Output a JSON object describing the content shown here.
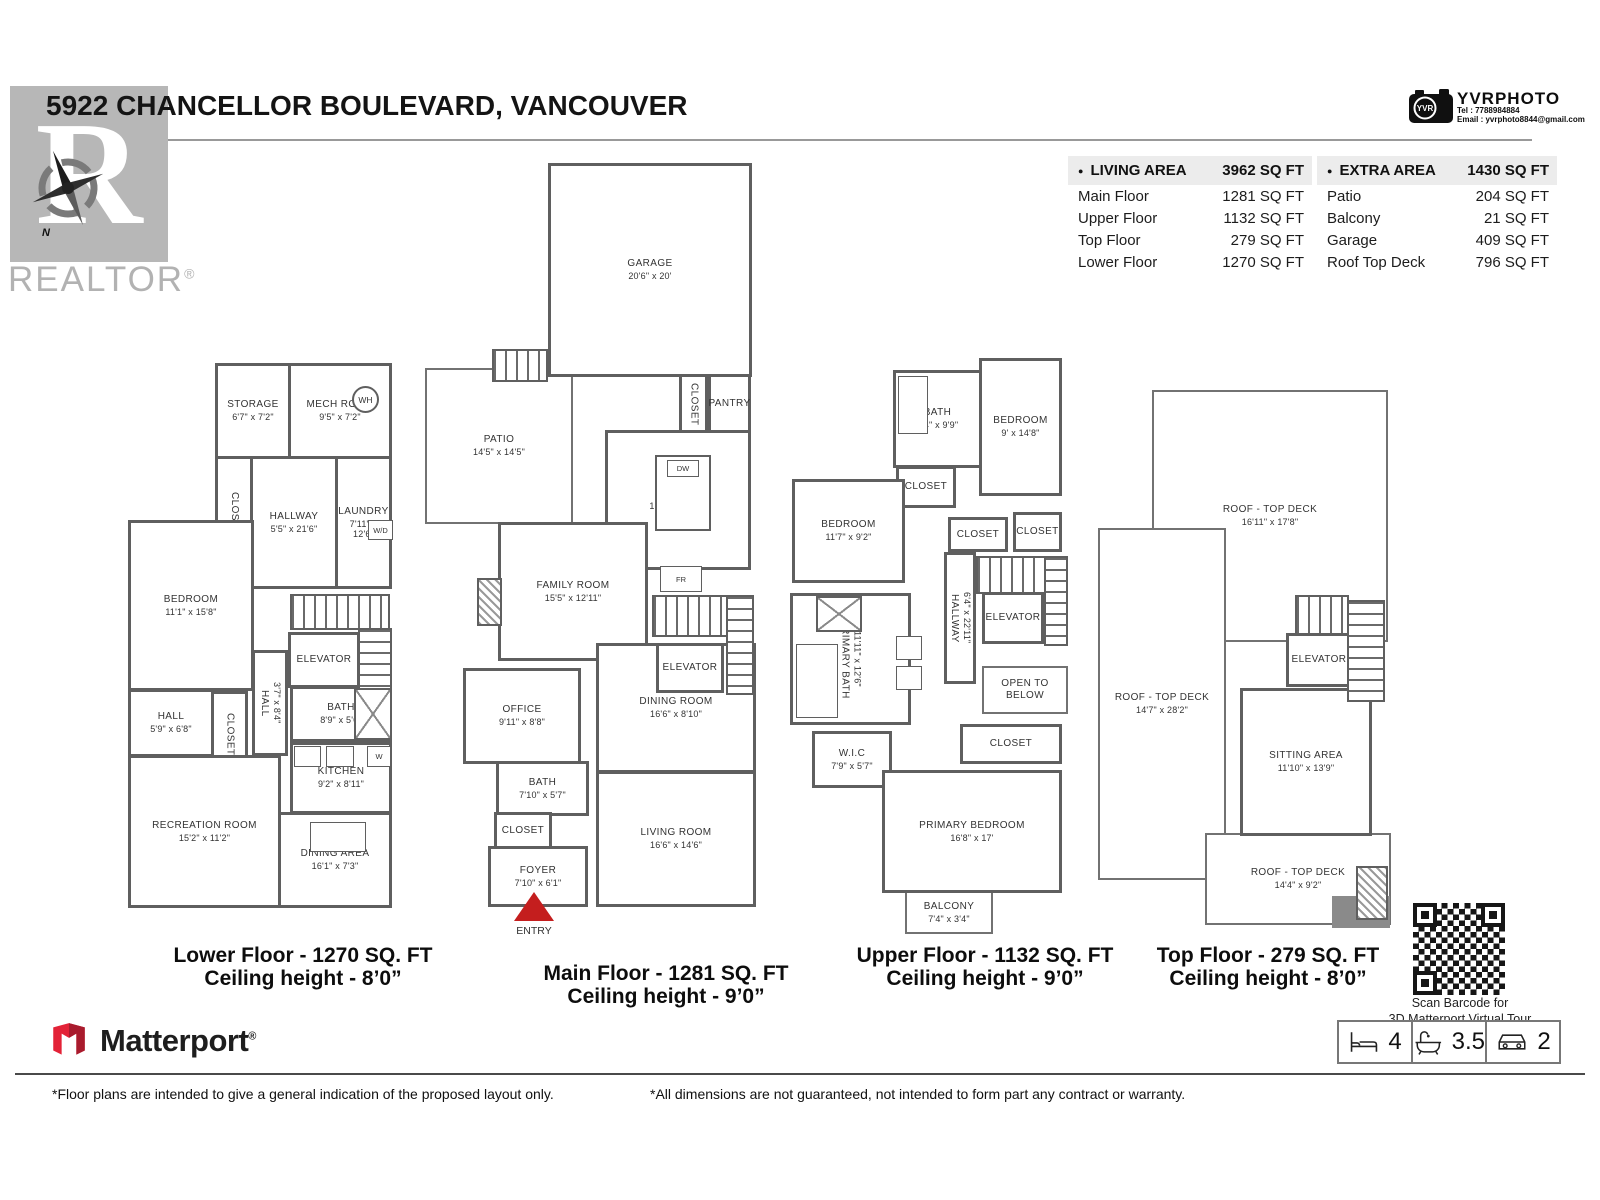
{
  "colors": {
    "wall": "#5f5f5f",
    "entry_red": "#c41e1e",
    "table_header_bg": "#ececec",
    "realtor_gray": "#b7b7b7",
    "matterport_red": "#e32237"
  },
  "header": {
    "title": "5922 CHANCELLOR BOULEVARD, VANCOUVER",
    "realtor": {
      "letter": "R",
      "wordmark": "REALTOR",
      "reg": "®",
      "compass_n": "N"
    },
    "photo": {
      "brand": "YVRPHOTO",
      "badge": "YVR",
      "tel": "Tel :  7788984884",
      "email": "Email :  yvrphoto8844@gmail.com"
    }
  },
  "area_tables": {
    "living": {
      "bullet": "●",
      "label": "LIVING AREA",
      "total": "3962 SQ FT",
      "rows": [
        {
          "label": "Main Floor",
          "value": "1281 SQ FT"
        },
        {
          "label": "Upper Floor",
          "value": "1132 SQ FT"
        },
        {
          "label": "Top Floor",
          "value": "279 SQ FT"
        },
        {
          "label": "Lower Floor",
          "value": "1270 SQ FT"
        }
      ]
    },
    "extra": {
      "bullet": "●",
      "label": "EXTRA AREA",
      "total": "1430 SQ FT",
      "rows": [
        {
          "label": "Patio",
          "value": "204 SQ FT"
        },
        {
          "label": "Balcony",
          "value": "21 SQ FT"
        },
        {
          "label": "Garage",
          "value": "409 SQ FT"
        },
        {
          "label": "Roof Top Deck",
          "value": "796 SQ FT"
        }
      ]
    }
  },
  "floors": {
    "lower": {
      "caption1": "Lower Floor - 1270 SQ. FT",
      "caption2": "Ceiling height - 8’0”",
      "labels": {
        "wh": "WH",
        "wd": "W/D",
        "w": "W"
      },
      "rooms": [
        {
          "name": "STORAGE",
          "dims": "6'7\" x 7'2\""
        },
        {
          "name": "MECH ROOM",
          "dims": "9'5\" x 7'2\""
        },
        {
          "name": "CLOSET",
          "dims": ""
        },
        {
          "name": "HALLWAY",
          "dims": "5'5\" x 21'6\""
        },
        {
          "name": "LAUNDRY",
          "dims": "7'11\" x 12'6\""
        },
        {
          "name": "CLOSET",
          "dims": ""
        },
        {
          "name": "BEDROOM",
          "dims": "11'1\" x 15'8\""
        },
        {
          "name": "ELEVATOR",
          "dims": ""
        },
        {
          "name": "BATH",
          "dims": "8'9\" x 5'6\""
        },
        {
          "name": "HALL",
          "dims": "3'7\" x 8'4\""
        },
        {
          "name": "HALL",
          "dims": "5'9\" x 6'8\""
        },
        {
          "name": "CLOSET",
          "dims": ""
        },
        {
          "name": "KITCHEN",
          "dims": "9'2\" x 8'11\""
        },
        {
          "name": "RECREATION ROOM",
          "dims": "15'2\" x 11'2\""
        },
        {
          "name": "DINING AREA",
          "dims": "16'1\" x 7'3\""
        }
      ]
    },
    "main": {
      "caption1": "Main Floor - 1281 SQ. FT",
      "caption2": "Ceiling height - 9’0”",
      "labels": {
        "dw": "DW",
        "fr": "FR",
        "entry": "ENTRY"
      },
      "rooms": [
        {
          "name": "GARAGE",
          "dims": "20'6\" x 20'"
        },
        {
          "name": "PATIO",
          "dims": "14'5\" x 14'5\""
        },
        {
          "name": "CLOSET",
          "dims": ""
        },
        {
          "name": "PANTRY",
          "dims": ""
        },
        {
          "name": "KITCHEN",
          "dims": "16'10\" x 16'6\""
        },
        {
          "name": "FAMILY ROOM",
          "dims": "15'5\" x 12'11\""
        },
        {
          "name": "ELEVATOR",
          "dims": ""
        },
        {
          "name": "OFFICE",
          "dims": "9'11\" x 8'8\""
        },
        {
          "name": "DINING ROOM",
          "dims": "16'6\" x 8'10\""
        },
        {
          "name": "BATH",
          "dims": "7'10\" x 5'7\""
        },
        {
          "name": "CLOSET",
          "dims": ""
        },
        {
          "name": "FOYER",
          "dims": "7'10\" x 6'1\""
        },
        {
          "name": "LIVING ROOM",
          "dims": "16'6\" x 14'6\""
        }
      ]
    },
    "upper": {
      "caption1": "Upper Floor - 1132 SQ. FT",
      "caption2": "Ceiling height - 9’0”",
      "rooms": [
        {
          "name": "BATH",
          "dims": "7'4\" x 9'9\""
        },
        {
          "name": "BEDROOM",
          "dims": "9' x 14'8\""
        },
        {
          "name": "CLOSET",
          "dims": ""
        },
        {
          "name": "BEDROOM",
          "dims": "11'7\" x 9'2\""
        },
        {
          "name": "CLOSET",
          "dims": ""
        },
        {
          "name": "CLOSET",
          "dims": ""
        },
        {
          "name": "HALLWAY",
          "dims": "6'4\" x 22'11\""
        },
        {
          "name": "ELEVATOR",
          "dims": ""
        },
        {
          "name": "PRIMARY BATH",
          "dims": "11'11\" x 12'6\""
        },
        {
          "name": "OPEN TO BELOW",
          "dims": ""
        },
        {
          "name": "W.I.C",
          "dims": "7'9\" x 5'7\""
        },
        {
          "name": "CLOSET",
          "dims": ""
        },
        {
          "name": "PRIMARY BEDROOM",
          "dims": "16'8\" x 17'"
        },
        {
          "name": "BALCONY",
          "dims": "7'4\" x 3'4\""
        }
      ]
    },
    "top": {
      "caption1": "Top Floor - 279 SQ. FT",
      "caption2": "Ceiling height - 8’0”",
      "rooms": [
        {
          "name": "ROOF - TOP DECK",
          "dims": "16'11\" x 17'8\""
        },
        {
          "name": "ROOF - TOP DECK",
          "dims": "14'7\" x 28'2\""
        },
        {
          "name": "ELEVATOR",
          "dims": ""
        },
        {
          "name": "SITTING AREA",
          "dims": "11'10\" x 13'9\""
        },
        {
          "name": "ROOF - TOP DECK",
          "dims": "14'4\" x 9'2\""
        }
      ]
    }
  },
  "footer": {
    "matterport": {
      "name": "Matterport",
      "reg": "®"
    },
    "qr_caption1": "Scan Barcode for",
    "qr_caption2": "3D Matterport Virtual Tour",
    "stats": {
      "beds": "4",
      "baths": "3.5",
      "parking": "2"
    },
    "disclaimer_left": "*Floor plans are intended to give a general indication of the proposed layout only.",
    "disclaimer_right": "*All dimensions are not guaranteed, not intended to form part any contract or warranty."
  }
}
